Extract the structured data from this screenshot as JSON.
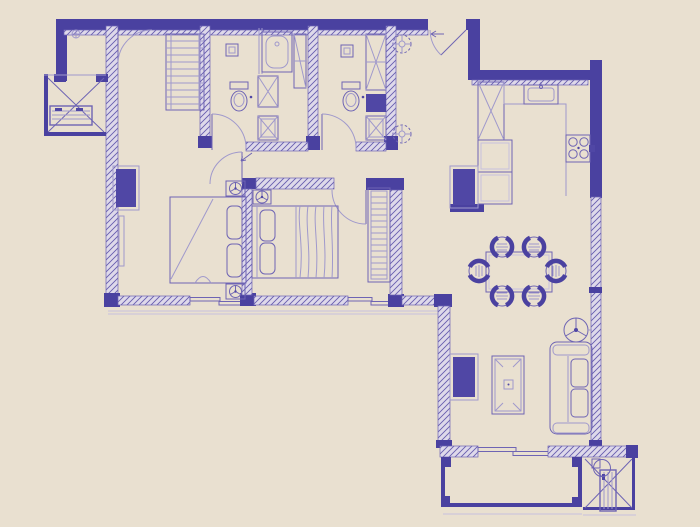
{
  "document": {
    "type": "apartment-floor-plan",
    "style": "blueprint-line-drawing"
  },
  "colors": {
    "bg": "#e9e0d0",
    "wall": "#4a41a0",
    "mid": "#6e64b4",
    "light": "#a099cc",
    "faint": "#c6c0de",
    "hatch-bg": "#ded9ea",
    "hatch-line": "#675dae",
    "fill-dark": "#5047a5"
  },
  "plan": {
    "rooms": [
      "master-bedroom",
      "bedroom-2",
      "bathroom-1",
      "bathroom-2",
      "dressing-closet",
      "hallway",
      "entry-foyer",
      "kitchen",
      "dining-area",
      "living-room",
      "balcony",
      "ac-platform-left",
      "ac-platform-right"
    ],
    "fixtures": [
      "double-bed-icon",
      "double-bed-icon",
      "wardrobe-icon",
      "wardrobe-icon",
      "table-lamp-icon",
      "table-lamp-icon",
      "table-lamp-icon",
      "toilet-icon",
      "toilet-icon",
      "bathtub-icon",
      "shower-stall-icon",
      "shower-drain-icon",
      "shower-drain-icon",
      "washbasin-icon",
      "washbasin-icon",
      "kitchen-sink-icon",
      "cooktop-4-burner-icon",
      "refrigerator-icon",
      "pantry-cabinet-icon",
      "dining-table-icon",
      "dining-chair-icon",
      "dining-chair-icon",
      "dining-chair-icon",
      "dining-chair-icon",
      "dining-chair-icon",
      "dining-chair-icon",
      "sofa-icon",
      "coffee-table-icon",
      "tv-console-icon",
      "floor-lamp-icon",
      "plant-icon",
      "plant-icon",
      "ac-outdoor-unit-icon",
      "ac-outdoor-unit-icon",
      "door-swing-icon",
      "door-swing-icon",
      "door-swing-icon",
      "door-swing-icon",
      "door-swing-icon",
      "door-swing-icon",
      "sliding-door-icon",
      "sliding-door-icon",
      "sliding-door-icon"
    ]
  }
}
